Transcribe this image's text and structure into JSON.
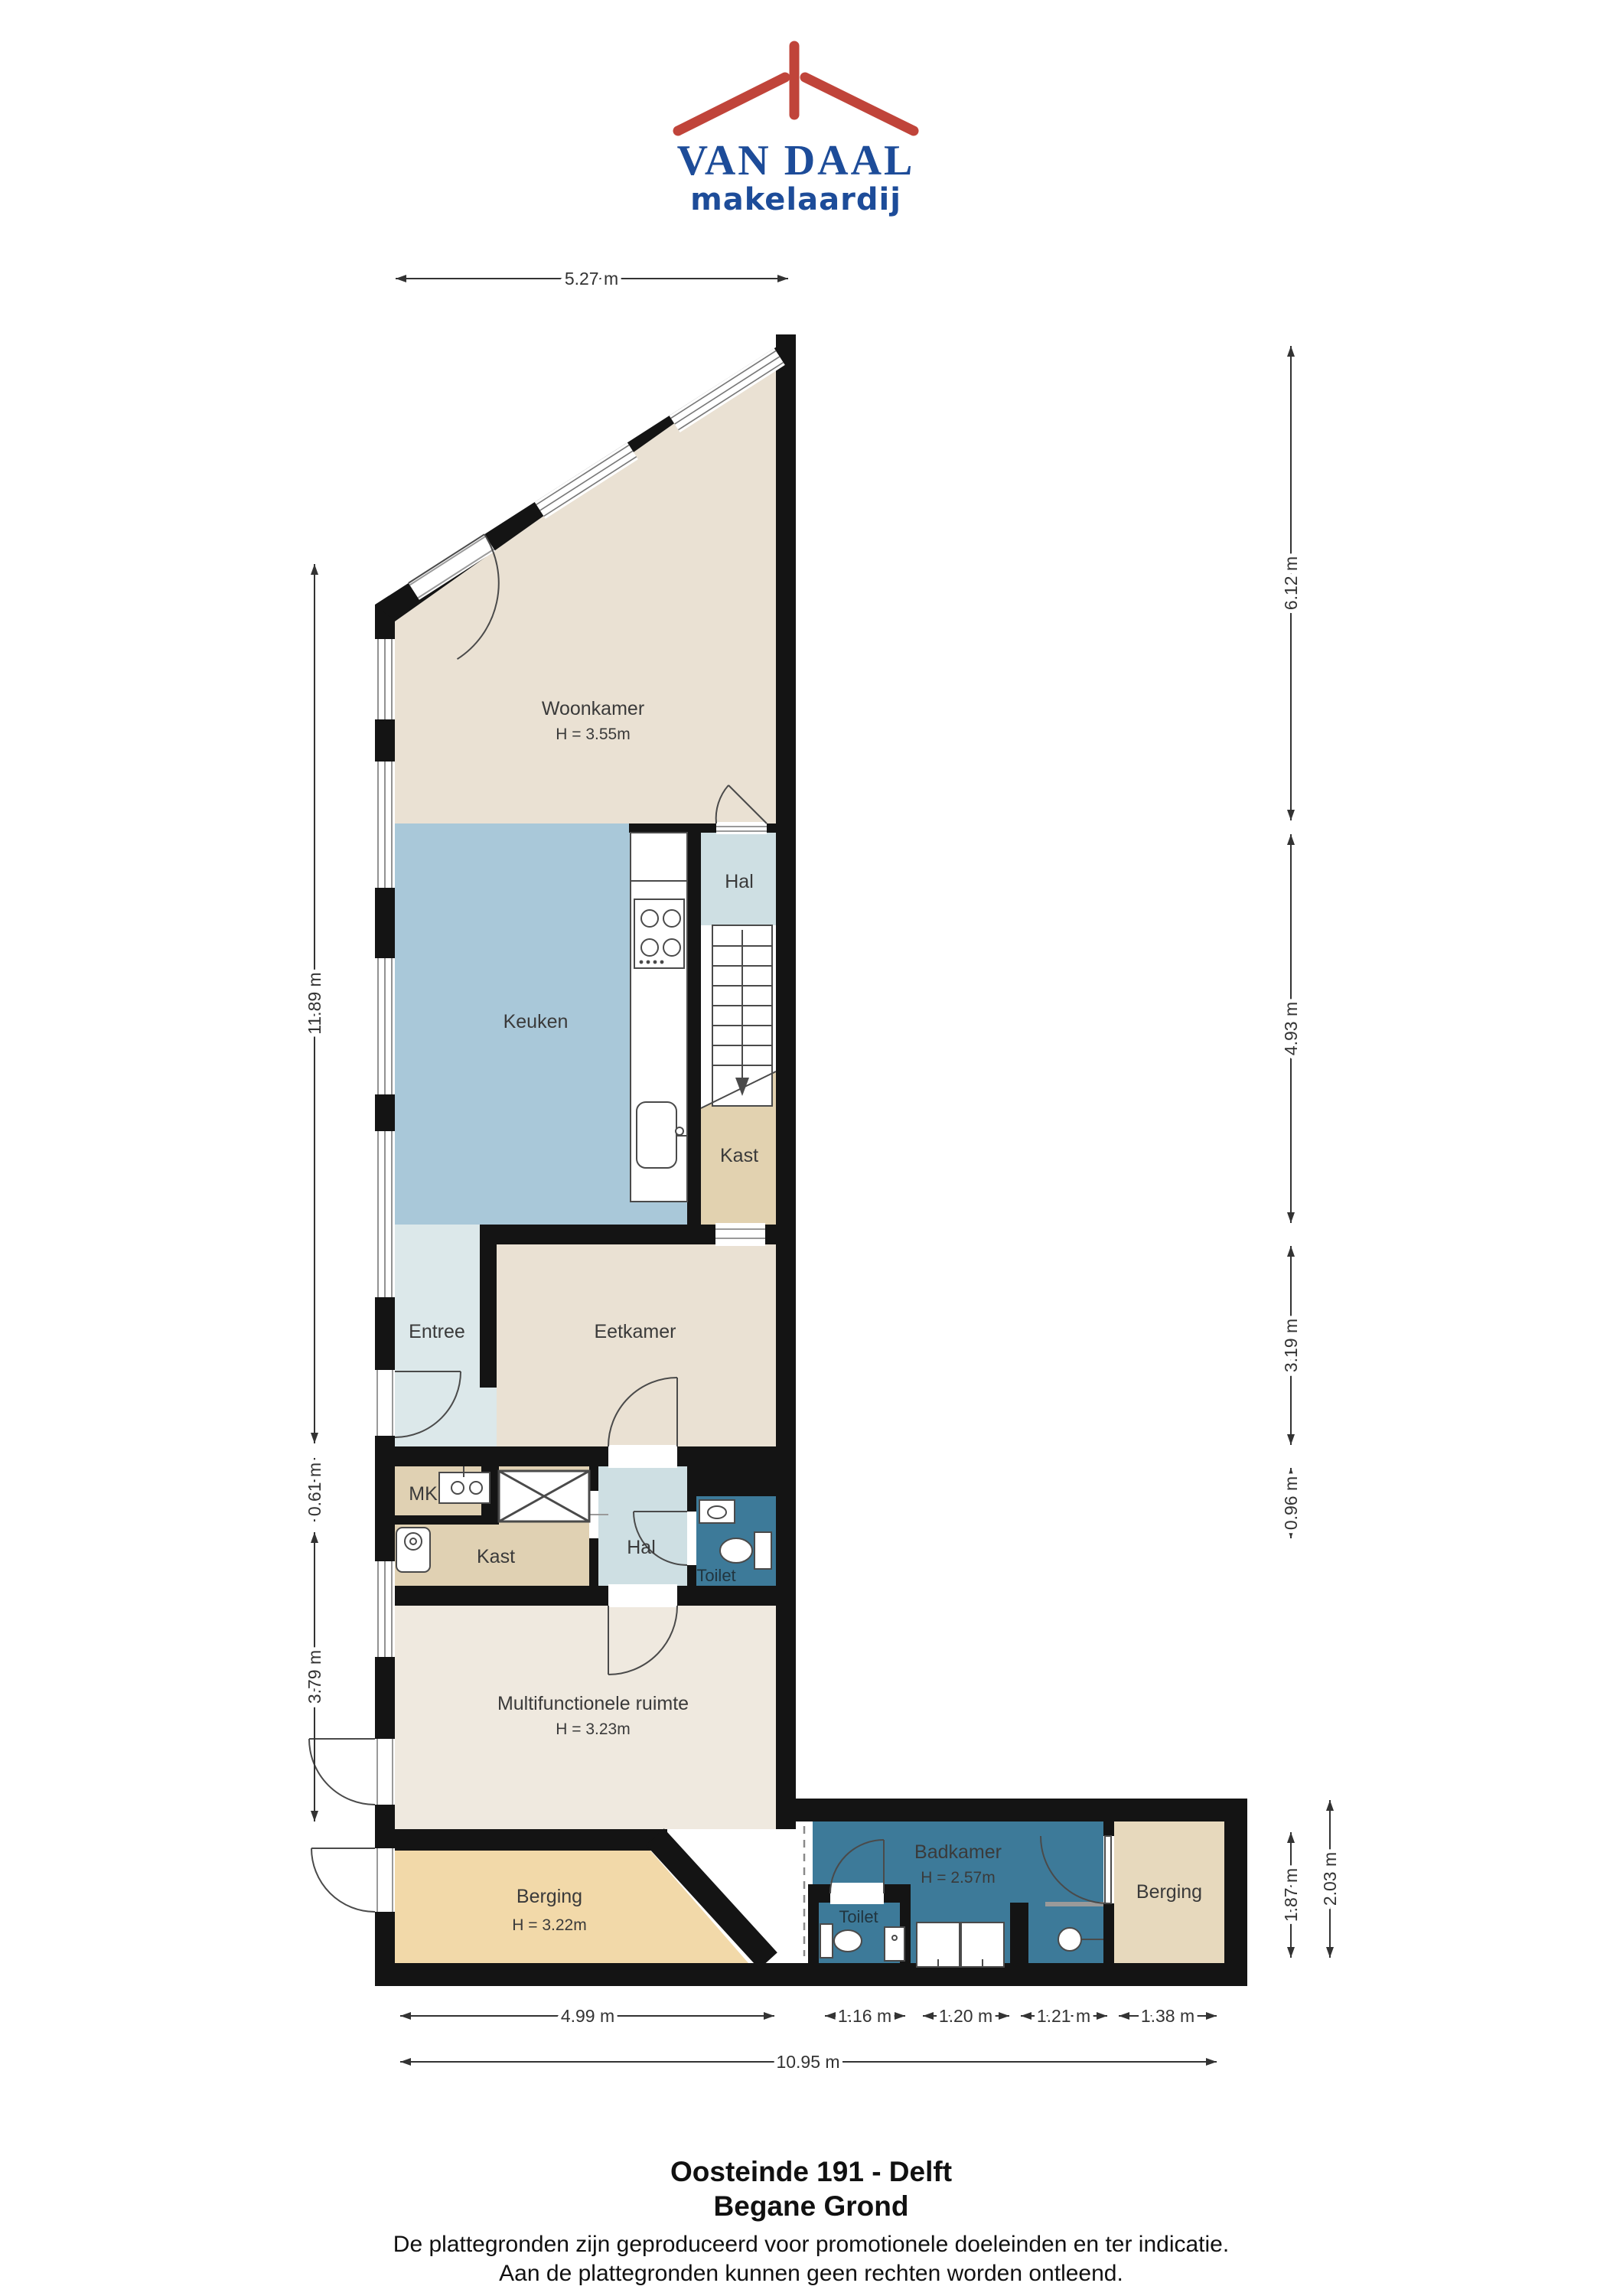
{
  "logo": {
    "title": "VAN DAAL",
    "subtitle": "makelaardij",
    "roof_color": "#c0443a",
    "text_color": "#1d4c99"
  },
  "title_block": {
    "address": "Oosteinde 191 - Delft",
    "floor": "Begane Grond",
    "disclaimer_line1": "De plattegronden zijn geproduceerd voor promotionele doeleinden en ter indicatie.",
    "disclaimer_line2": "Aan de plattegronden kunnen geen rechten worden ontleend."
  },
  "rooms": {
    "woonkamer": {
      "name": "Woonkamer",
      "height": "H = 3.55m",
      "color": "#eae1d3"
    },
    "keuken": {
      "name": "Keuken",
      "color": "#a9c8d9"
    },
    "hal_boven": {
      "name": "Hal",
      "color": "#cedfe3"
    },
    "kast_boven": {
      "name": "Kast",
      "color": "#e2d2b0"
    },
    "entree": {
      "name": "Entree",
      "color": "#dce8ea"
    },
    "eetkamer": {
      "name": "Eetkamer",
      "color": "#eae1d3"
    },
    "mk": {
      "name": "MK",
      "color": "#e0d1b3"
    },
    "kast_onder": {
      "name": "Kast",
      "color": "#e0d1b3"
    },
    "hal_onder": {
      "name": "Hal",
      "color": "#cedfe3"
    },
    "toilet_hal": {
      "name": "Toilet",
      "color": "#3d7a99"
    },
    "multifunctionele_ruimte": {
      "name": "Multifunctionele ruimte",
      "height": "H = 3.23m",
      "color": "#efe9df"
    },
    "berging_links": {
      "name": "Berging",
      "height": "H = 3.22m",
      "color": "#f2d9a9"
    },
    "toilet_achter": {
      "name": "Toilet",
      "color": "#3d7a99"
    },
    "badkamer": {
      "name": "Badkamer",
      "height": "H = 2.57m",
      "color": "#3d7a99"
    },
    "berging_rechts": {
      "name": "Berging",
      "color": "#e7d9bd"
    }
  },
  "fixtures": [
    "stove-icon",
    "kitchen-sink-icon",
    "staircase-down-arrow",
    "wardrobe-cross-symbol",
    "mk-sink-icon",
    "water-heater-icon",
    "toilet-icon",
    "hand-basin-icon",
    "washing-machine-icon",
    "washing-machine-icon",
    "shower-icon",
    "toilet-icon",
    "cabinet-icon"
  ],
  "dimensions": {
    "top": [
      "5.27 m"
    ],
    "left": [
      "11.89 m",
      "0.61 m",
      "3.79 m"
    ],
    "right": [
      "6.12 m",
      "4.93 m",
      "3.19 m",
      "0.96 m"
    ],
    "wing_right": [
      "1.87 m",
      "2.03 m"
    ],
    "bottom": [
      "4.99 m",
      "1.16 m",
      "1.20 m",
      "1.21 m",
      "1.38 m"
    ],
    "bottom_total": "10.95 m"
  },
  "colors": {
    "wall": "#141414",
    "dimension": "#333333",
    "fixture_stroke": "#4a4a4a",
    "window_line": "#777777"
  }
}
